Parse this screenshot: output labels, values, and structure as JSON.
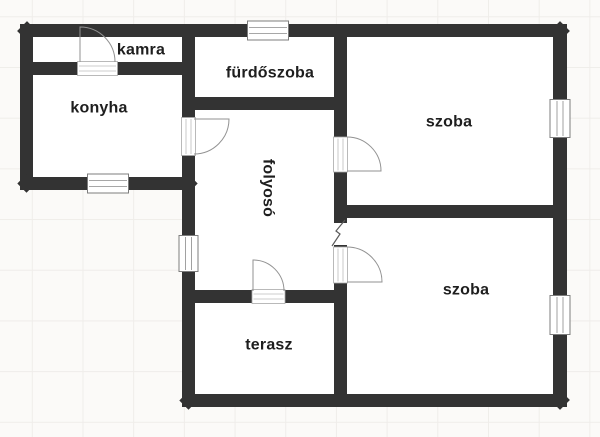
{
  "document": {
    "kind": "floor-plan",
    "language": "hu"
  },
  "rooms": [
    {
      "id": "kamra",
      "label": "kamra"
    },
    {
      "id": "konyha",
      "label": "konyha"
    },
    {
      "id": "furdoszoba",
      "label": "fürdőszoba"
    },
    {
      "id": "folyoso",
      "label": "folyosó"
    },
    {
      "id": "szoba_top",
      "label": "szoba"
    },
    {
      "id": "szoba_bottom",
      "label": "szoba"
    },
    {
      "id": "terasz",
      "label": "terasz"
    }
  ],
  "symbols": {
    "window": "hatched-rect-in-wall",
    "door": "quarter-arc-with-leaf",
    "wall_break": "diagonal-zigzag",
    "window_count": 5,
    "door_count": 5
  },
  "colors": {
    "wall": "#333333",
    "background": "#fbfaf8",
    "grid_line": "#efedea",
    "room_fill": "#ffffff",
    "door_stroke": "#929292",
    "label_text": "#1e1e1e"
  }
}
